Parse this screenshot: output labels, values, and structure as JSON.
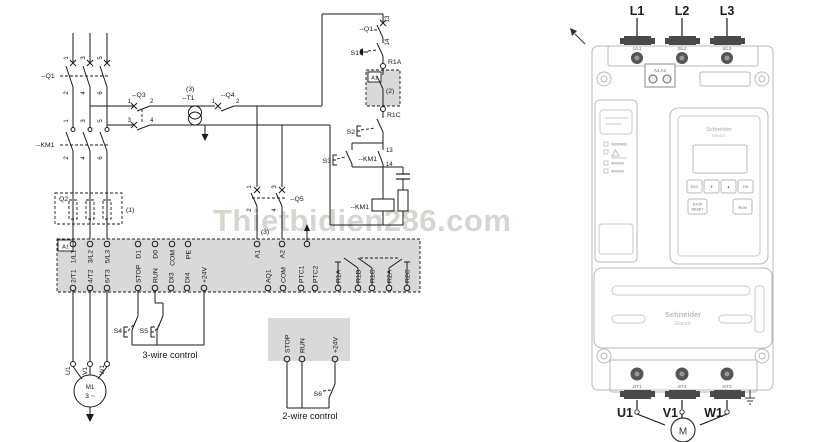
{
  "watermark": "Thietbidien286.com",
  "schematic": {
    "q1": {
      "label": "--Q1",
      "poles_top": [
        "1",
        "3",
        "5"
      ],
      "poles_bottom": [
        "2",
        "4",
        "6"
      ]
    },
    "km1": {
      "label": "--KM1",
      "poles_top": [
        "1",
        "3",
        "5"
      ],
      "poles_bottom": [
        "2",
        "4",
        "6"
      ]
    },
    "q2": {
      "label": "Q2",
      "note": "(1)"
    },
    "q3": {
      "label": "--Q3",
      "n": [
        "1",
        "2",
        "3",
        "4"
      ]
    },
    "t1": {
      "label": "--T1",
      "note": "(3)"
    },
    "q4": {
      "label": "--Q4",
      "n": [
        "1",
        "2"
      ]
    },
    "q5": {
      "label": "--Q5",
      "n": [
        "1",
        "2",
        "3",
        "4"
      ],
      "note": "(3)"
    },
    "control": {
      "q1aux_label": "--Q1",
      "q1aux_13": "13",
      "q1aux_14": "14",
      "s1": "S1",
      "s2": "S2",
      "s3": "S3",
      "r1a": "R1A",
      "r1c": "R1C",
      "a1_box": "A1",
      "note2": "(2)",
      "km1aux_label": "--KM1",
      "km1aux_13": "13",
      "km1aux_14": "14",
      "km1coil_label": "--KM1"
    },
    "strip": {
      "corner": "A1",
      "top": [
        "1/L1",
        "3/L2",
        "5/L3",
        "D1",
        "D0",
        "COM",
        "PE",
        "A1",
        "A2"
      ],
      "bottom": [
        "2/T1",
        "4/T2",
        "6/T3",
        "STOP",
        "RUN",
        "DI3",
        "DI4",
        "+24V",
        "AQ1",
        "COM",
        "PTC1",
        "PTC2",
        "R1A",
        "R1B",
        "R1C",
        "R2A",
        "R2C"
      ]
    },
    "three_wire": {
      "s4": "S4",
      "s5": "S5",
      "caption": "3-wire control"
    },
    "two_wire": {
      "terminals": [
        "STOP",
        "RUN",
        "+24V"
      ],
      "s6": "S6",
      "caption": "2-wire control"
    },
    "motor": {
      "terminals": [
        "U1",
        "V1",
        "W1"
      ],
      "name": "M1",
      "phase": "3 ~"
    }
  },
  "device": {
    "input_labels": [
      "L1",
      "L2",
      "L3"
    ],
    "input_terminals": [
      "1/L1",
      "3/L2",
      "5/L3"
    ],
    "aux_terminals": "A1  A2",
    "keypad": {
      "logo_line1": "Schneider",
      "logo_line2": "Electric",
      "buttons": [
        "ESC",
        "▼",
        "▲",
        "OK"
      ],
      "stop_line1": "STOP",
      "stop_line2": "RESET",
      "run": "RUN"
    },
    "lower_logo_line1": "Schneider",
    "lower_logo_line2": "Electric",
    "output_terminals": [
      "2/T1",
      "4/T2",
      "6/T3"
    ],
    "output_labels": [
      "U1",
      "V1",
      "W1"
    ],
    "motor": "M"
  }
}
